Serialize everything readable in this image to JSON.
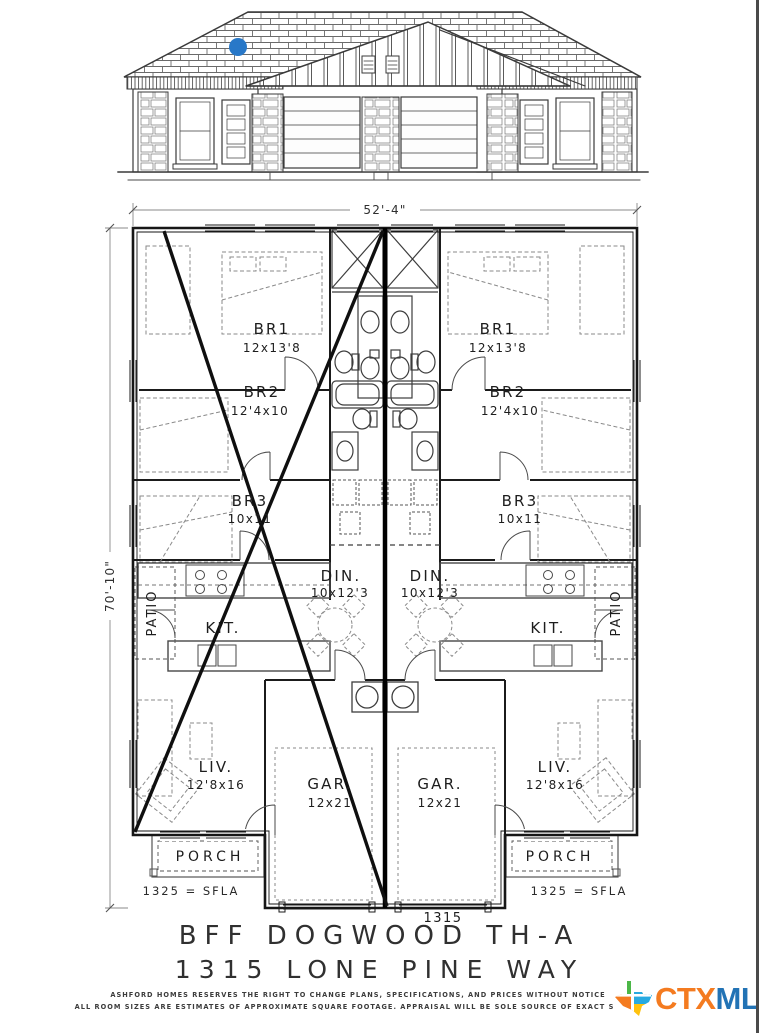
{
  "plan": {
    "dimensions": {
      "width_total": "52'-4\"",
      "height_total": "70'-10\""
    },
    "rooms": {
      "br1": {
        "name": "BR1",
        "size": "12x13'8"
      },
      "br2": {
        "name": "BR2",
        "size": "12'4x10"
      },
      "br3": {
        "name": "BR3",
        "size": "10x11"
      },
      "din": {
        "name": "DIN.",
        "size": "10x12'3"
      },
      "kit": {
        "name": "KIT."
      },
      "liv": {
        "name": "LIV.",
        "size": "12'8x16"
      },
      "gar": {
        "name": "GAR.",
        "size": "12x21"
      },
      "porch": {
        "name": "PORCH"
      },
      "patio": {
        "name": "PATIO"
      }
    },
    "sfla_label": "1325 = SFLA",
    "unit_number": "1315"
  },
  "title": {
    "line1": "BFF DOGWOOD TH-A",
    "line2": "1315 LONE PINE WAY"
  },
  "disclaimer": {
    "line1": "ASHFORD HOMES RESERVES THE RIGHT TO CHANGE PLANS, SPECIFICATIONS, AND PRICES WITHOUT NOTICE",
    "line2": "ALL ROOM SIZES ARE ESTIMATES OF APPROXIMATE SQUARE FOOTAGE. APPRAISAL WILL BE SOLE SOURCE OF EXACT SQ. FT."
  },
  "logo": {
    "ctx": "CTX",
    "mls": "MLS",
    "ctx_color": "#F47B20",
    "mls_color": "#2273B5"
  },
  "colors": {
    "marker_blue": "#2878C8",
    "line_dark": "#1b1b1b"
  }
}
